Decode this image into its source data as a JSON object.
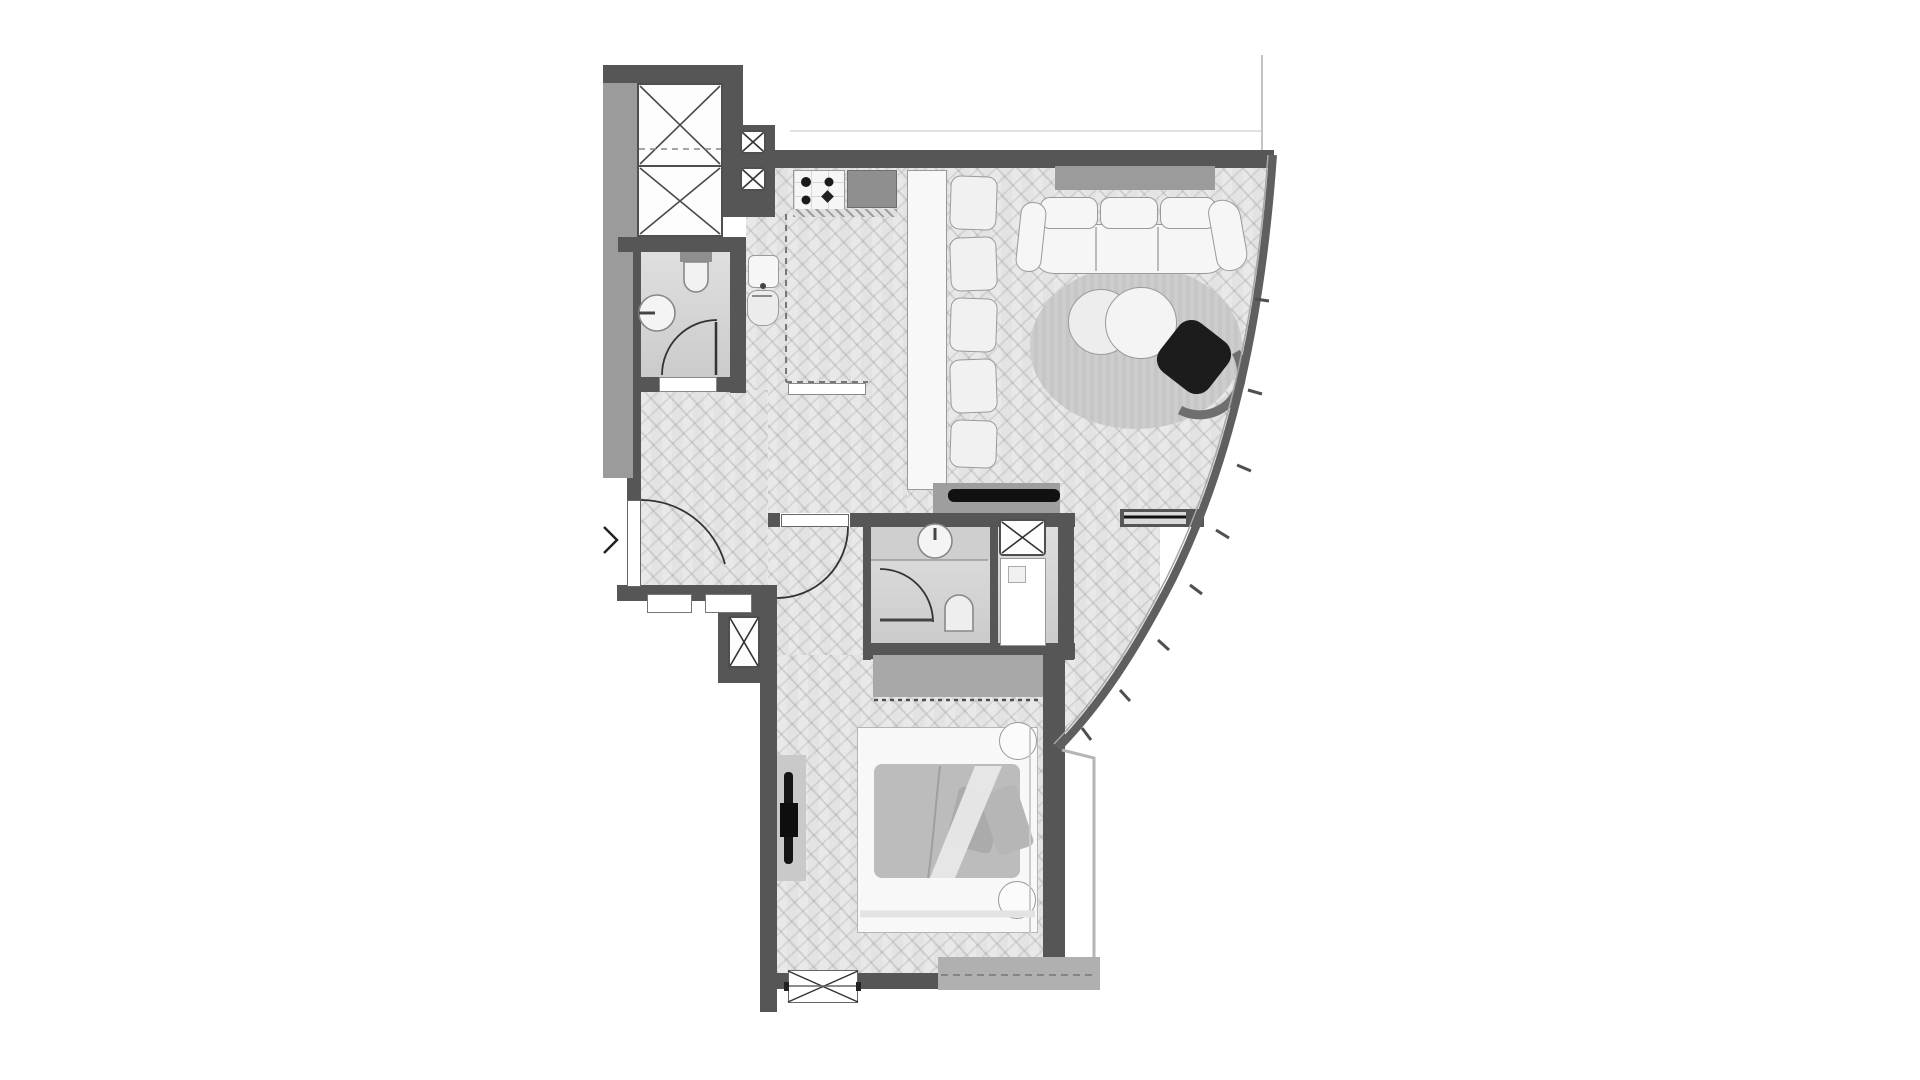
{
  "meta": {
    "title": "Apartment floor plan",
    "type": "architectural-floor-plan",
    "render_style": "grayscale top-down plan with herringbone wood floors and curved glass facade"
  },
  "palette": {
    "wall": "#565656",
    "lwall": "#9b9b9b",
    "floor": "#e3e3e3",
    "tile": "#d6d6d6",
    "fur": "#f6f6f6",
    "line": "#9a9a9a",
    "dark": "#1c1c1c",
    "rug": "#c6c6c6",
    "wardrobe": "#a8a8a8",
    "slab": "#b0b0b0",
    "duvet": "#bcbcbc",
    "console": "#9e9e9e",
    "counter": "#8f8f8f"
  },
  "labels": {
    "plan": "Apartment floor plan",
    "elevator": "Elevator shaft with crossed-box symbol",
    "duct": "Service shaft crossed box",
    "bath1": "Guest bathroom with toilet, round basin and swing door",
    "kitchen": "Kitchen with cooktop, counter, sink, tall appliance and island",
    "island": "Kitchen island counter",
    "bench": "Bench seat cushion",
    "hall": "Entry hall with herringbone floor",
    "entrydoor": "Entrance door with swing arc",
    "living": "Living room",
    "sofa": "Three-seat sofa with curved arms",
    "rug": "Round area rug",
    "tables": "Nesting round coffee tables",
    "armchair": "Dark swivel armchair",
    "tvconsole": "TV console with flat screen",
    "facade": "Curved glazed facade with mullions",
    "bath2": "Master bathroom with vanity basin, toilet and shower",
    "washer": "Washer / service shaft crossed box",
    "shower": "Shower tray",
    "corridor": "Bedroom corridor",
    "bedroomdoor": "Bedroom door with swing arc",
    "bedroom": "Bedroom",
    "wardrobe": "Wardrobe with dashed sliding front",
    "bed": "Double bed with duvet and round pillows",
    "bedtv": "Wall-mounted TV",
    "window": "Bedroom window with crossed symbol",
    "slab": "Balcony slab edge",
    "niche": "Wall niche",
    "hallshaft": "Corridor shaft crossed box",
    "refline": "Facade reference line"
  },
  "rooms": [
    {
      "id": "elevator-shaft",
      "label": "Elevator shaft"
    },
    {
      "id": "guest-bathroom",
      "label": "Guest bathroom",
      "fixtures": [
        "toilet",
        "round basin",
        "swing door"
      ]
    },
    {
      "id": "kitchen",
      "label": "Kitchen",
      "features": [
        "4-burner cooktop",
        "dark counter",
        "sink",
        "tall appliance",
        "island counter",
        "4 bench seats"
      ]
    },
    {
      "id": "entry-hall",
      "label": "Entry hall",
      "features": [
        "entrance door",
        "herringbone floor",
        "wall niches"
      ]
    },
    {
      "id": "living-room",
      "label": "Living room",
      "features": [
        "sofa",
        "round rug",
        "two nesting coffee tables",
        "dark armchair",
        "TV console",
        "curved glass facade"
      ]
    },
    {
      "id": "master-bathroom",
      "label": "Master bathroom",
      "fixtures": [
        "vanity basin",
        "toilet",
        "shower tray",
        "washer shaft",
        "swing door"
      ]
    },
    {
      "id": "bedroom",
      "label": "Bedroom",
      "features": [
        "double bed",
        "two round pillows",
        "wardrobe",
        "wall TV",
        "window",
        "balcony slab"
      ]
    }
  ],
  "symbols": [
    {
      "id": "crossed-box",
      "meaning": "shaft / void / appliance"
    },
    {
      "id": "quarter-arc",
      "meaning": "door swing"
    },
    {
      "id": "dashed-line",
      "meaning": "overhead edge / zone boundary / sliding front"
    },
    {
      "id": "window-x",
      "meaning": "window opening"
    }
  ]
}
